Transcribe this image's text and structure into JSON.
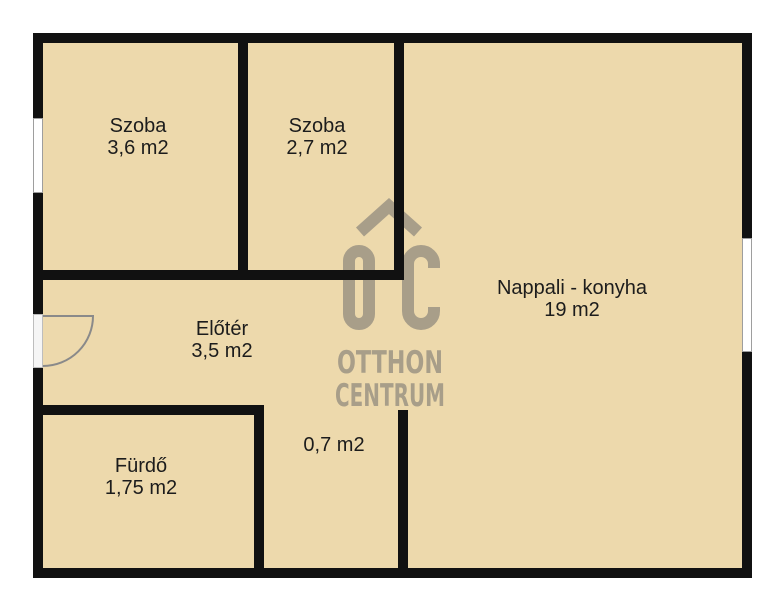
{
  "floorplan": {
    "rooms": [
      {
        "name": "Szoba",
        "area": "3,6 m2"
      },
      {
        "name": "Szoba",
        "area": "2,7 m2"
      },
      {
        "name": "Nappali - konyha",
        "area": "19 m2"
      },
      {
        "name": "Előtér",
        "area": "3,5 m2"
      },
      {
        "name": "Fürdő",
        "area": "1,75 m2"
      },
      {
        "name": "",
        "area": "0,7 m2"
      }
    ],
    "colors": {
      "floor": "#edd9ac",
      "wall": "#111111",
      "watermark": "#a89e89",
      "label_text": "#1c1c1c",
      "background": "#ffffff"
    }
  },
  "watermark": {
    "logo_text": "OC",
    "line1": "OTTHON",
    "line2": "CENTRUM"
  }
}
